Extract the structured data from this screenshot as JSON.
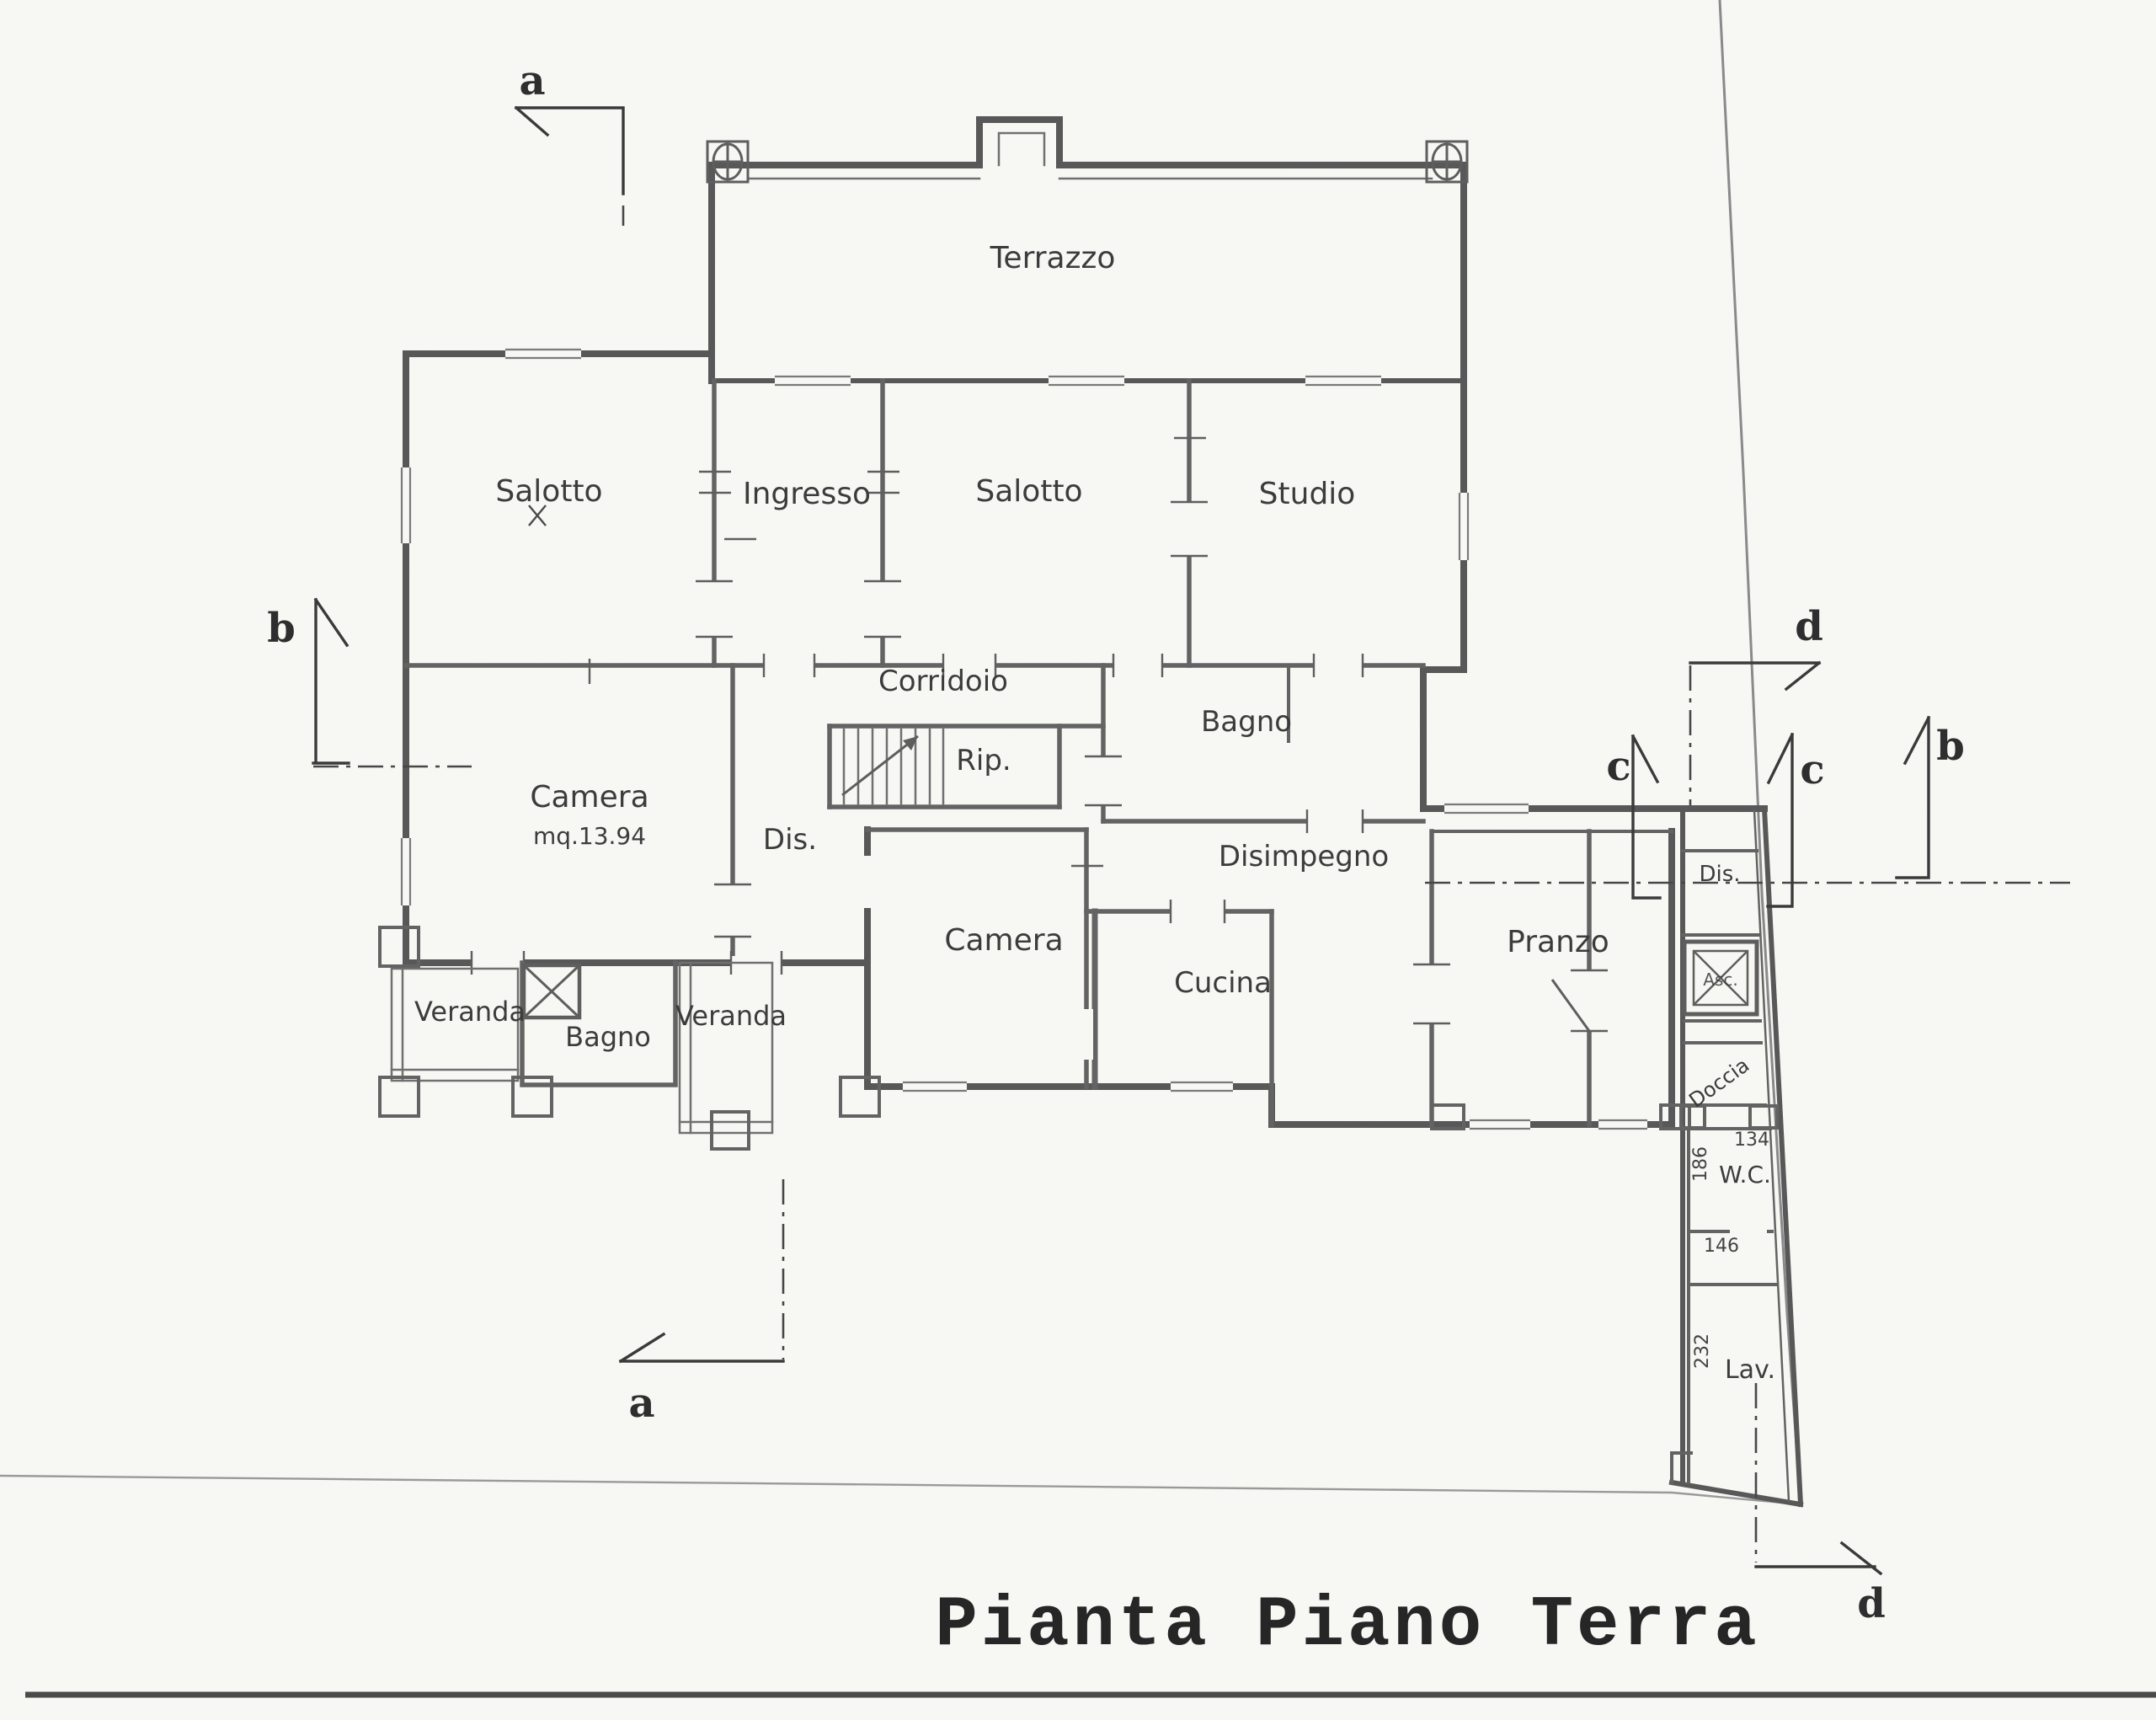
{
  "title": "Pianta Piano Terra",
  "colors": {
    "paper": "#f7f7f4",
    "ink": "#3c3c3c",
    "wall": "#585858"
  },
  "rooms": {
    "terrazzo": "Terrazzo",
    "salotto_1": "Salotto",
    "ingresso": "Ingresso",
    "salotto_2": "Salotto",
    "studio": "Studio",
    "corridoio": "Corridoio",
    "rip": "Rip.",
    "bagno_1": "Bagno",
    "dis_1": "Dis.",
    "camera_1": "Camera",
    "camera_1_area": "mq.13.94",
    "disimpegno": "Disimpegno",
    "camera_2": "Camera",
    "cucina": "Cucina",
    "pranzo": "Pranzo",
    "veranda_1": "Veranda",
    "bagno_2": "Bagno",
    "veranda_2": "Veranda",
    "dis_2": "Dis.",
    "asc": "Asc.",
    "doccia": "Doccia",
    "wc": "W.C.",
    "lav": "Lav."
  },
  "dimensions": {
    "w186": "186",
    "w134": "134",
    "w146": "146",
    "w232": "232"
  },
  "sections": {
    "a_top": "a",
    "a_bottom": "a",
    "b_left": "b",
    "b_right": "b",
    "c_left": "c",
    "c_right": "c",
    "d_top": "d",
    "d_bottom": "d"
  }
}
